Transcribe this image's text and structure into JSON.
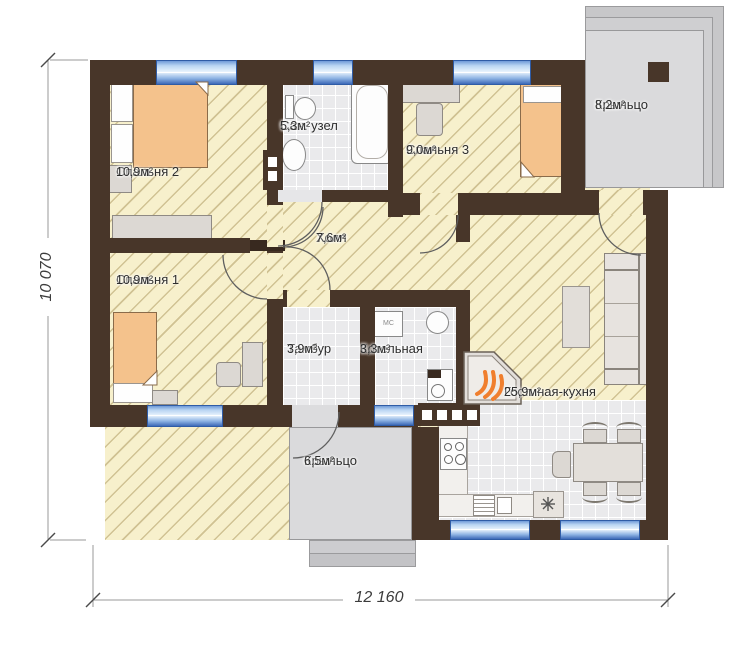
{
  "rooms": [
    {
      "key": "bedroom2",
      "name": "Спальня 2",
      "area": "10,9м²"
    },
    {
      "key": "bedroom1",
      "name": "Спальня 1",
      "area": "10,9м²"
    },
    {
      "key": "bathroom",
      "name": "Сан. узел",
      "area": "5,3м²"
    },
    {
      "key": "bedroom3",
      "name": "Спальня 3",
      "area": "9,0м²"
    },
    {
      "key": "hall",
      "name": "Холл",
      "area": "7,6м²"
    },
    {
      "key": "vestibule",
      "name": "Тамбур",
      "area": "3,9м²"
    },
    {
      "key": "boiler_room",
      "name": "Котельная",
      "area": "3,3м²"
    },
    {
      "key": "living_kitchen",
      "name": "Гостиная-кухня",
      "area": "25,9м²"
    },
    {
      "key": "porch_top",
      "name": "Крыльцо",
      "area": "8,2м²"
    },
    {
      "key": "porch_bottom",
      "name": "Крыльцо",
      "area": "6,5м²"
    }
  ],
  "dimensions": {
    "vertical": "10 070",
    "horizontal": "12 160"
  },
  "appliances": {
    "washing_machine": "МС"
  },
  "colors": {
    "wall": "#483629",
    "floor": "#f7f0cc",
    "hatch_line": "#b09c64",
    "tile": "#eaeaec",
    "window_blue": "#4a7ed2",
    "furniture_orange": "#f4c28c",
    "porch_gray": "#dadadc",
    "flame": "#f07f2e"
  }
}
